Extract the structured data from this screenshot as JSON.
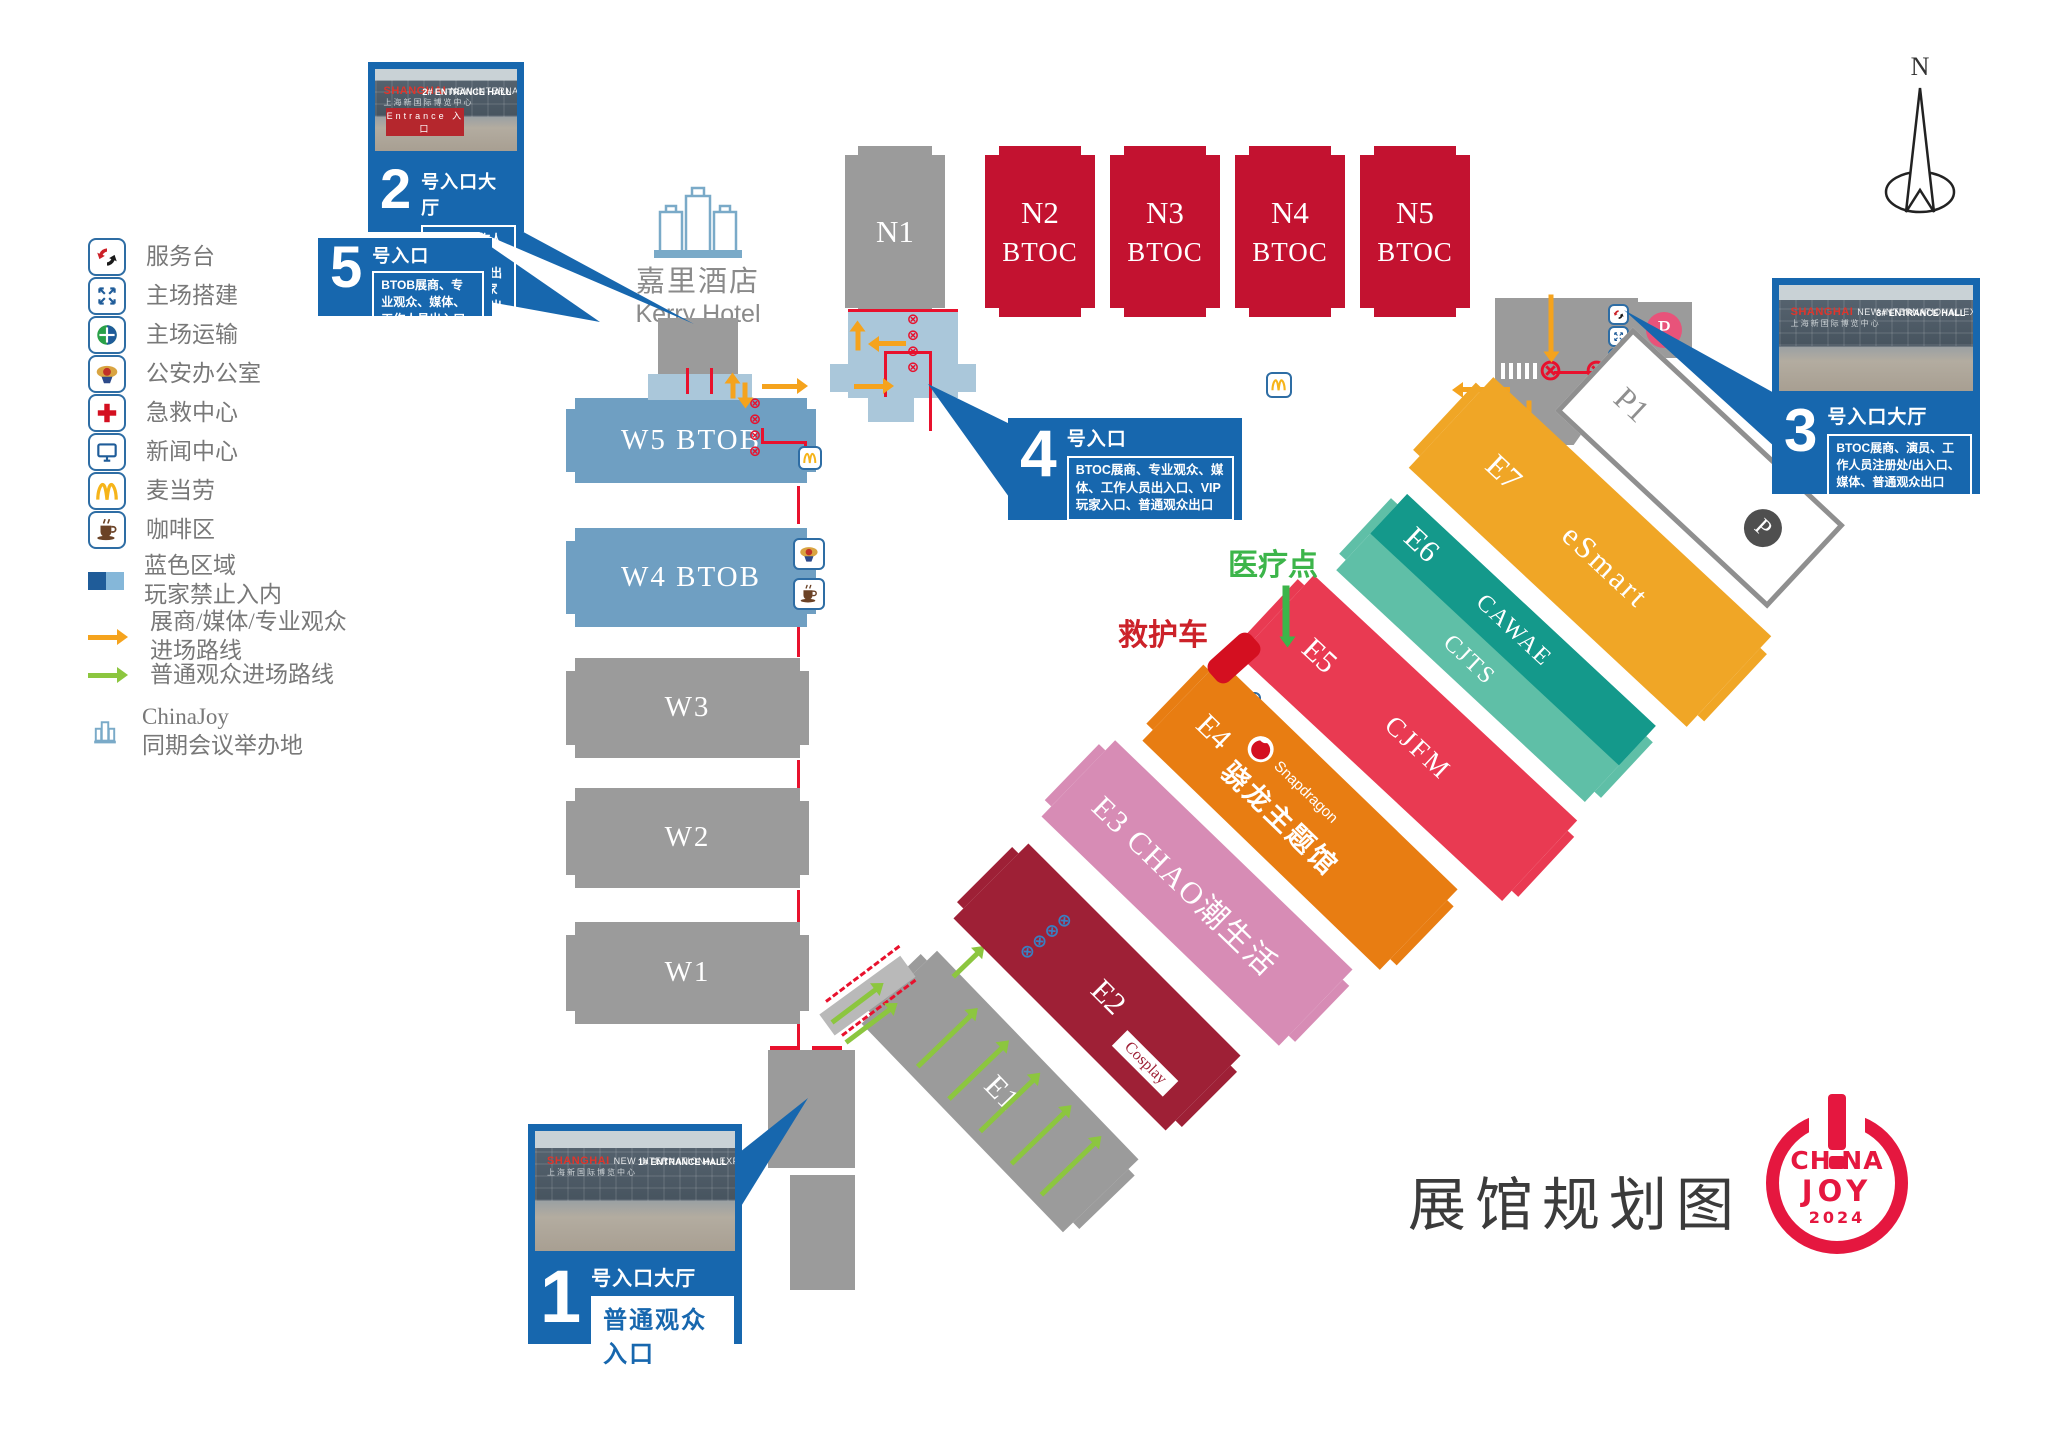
{
  "page": {
    "title": "展馆规划图"
  },
  "compass": {
    "label": "N"
  },
  "colors": {
    "callout_blue": "#1767ae",
    "hall_red": "#c31230",
    "hall_gray": "#9b9b9b",
    "hall_btob_blue": "#6f9fc2",
    "corridor_blue": "#aac7da",
    "route_orange": "#f5a31d",
    "route_green": "#8cc63f",
    "fence_red": "#e8112d",
    "logo_red": "#e5173f"
  },
  "legend": {
    "items": [
      {
        "icon": "service-desk-icon",
        "label": "服务台"
      },
      {
        "icon": "venue-setup-icon",
        "label": "主场搭建"
      },
      {
        "icon": "venue-transport-icon",
        "label": "主场运输"
      },
      {
        "icon": "police-office-icon",
        "label": "公安办公室"
      },
      {
        "icon": "first-aid-icon",
        "label": "急救中心"
      },
      {
        "icon": "news-center-icon",
        "label": "新闻中心"
      },
      {
        "icon": "mcdonalds-icon",
        "label": "麦当劳"
      },
      {
        "icon": "coffee-area-icon",
        "label": "咖啡区"
      },
      {
        "icon": "blue-area-swatch",
        "label1": "蓝色区域",
        "label2": "玩家禁止入内"
      },
      {
        "icon": "orange-route-arrow",
        "label1": "展商/媒体/专业观众",
        "label2": "进场路线"
      },
      {
        "icon": "green-route-arrow",
        "label": "普通观众进场路线"
      },
      {
        "icon": "conference-venue-icon",
        "label1": "ChinaJoy",
        "label2": "同期会议举办地"
      }
    ]
  },
  "kerry_hotel": {
    "cn": "嘉里酒店",
    "en": "Kerry Hotel"
  },
  "entrances": {
    "e1": {
      "num": "1",
      "title": "号入口大厅",
      "desc": "普通观众入口"
    },
    "e2": {
      "num": "2",
      "title": "号入口大厅",
      "desc": "展商、工作人员、专业观众、媒体进出口、VIP玩家入口、玩家出口"
    },
    "e3": {
      "num": "3",
      "title": "号入口大厅",
      "desc": "BTOC展商、演员、工作人员注册处/出入口、媒体、普通观众出口"
    },
    "e4": {
      "num": "4",
      "title": "号入口",
      "desc": "BTOC展商、专业观众、媒体、工作人员出入口、VIP玩家入口、普通观众出口"
    },
    "e5": {
      "num": "5",
      "title": "号入口",
      "desc": "BTOB展商、专业观众、媒体、工作人员出入口"
    }
  },
  "photo": {
    "sign_red": "SHANGHAI",
    "sign_white": "NEW INTERNATIONAL EXPO CENTRE",
    "sign_cn": "上海新国际博览中心",
    "hall2": "2# ENTRANCE HALL",
    "hall1": "1# ENTRANCE HALL",
    "hall3": "3# ENTRANCE HALL",
    "banner": "Entrance 入口"
  },
  "halls": {
    "north": [
      {
        "id": "N1",
        "sub": ""
      },
      {
        "id": "N2",
        "sub": "BTOC"
      },
      {
        "id": "N3",
        "sub": "BTOC"
      },
      {
        "id": "N4",
        "sub": "BTOC"
      },
      {
        "id": "N5",
        "sub": "BTOC"
      }
    ],
    "west": [
      {
        "label": "W5 BTOB"
      },
      {
        "label": "W4 BTOB"
      },
      {
        "label": "W3"
      },
      {
        "label": "W2"
      },
      {
        "label": "W1"
      }
    ],
    "east": [
      {
        "id": "E1",
        "name": ""
      },
      {
        "id": "E2",
        "name": "Cosplay"
      },
      {
        "id": "E3",
        "name": "CHAO潮生活"
      },
      {
        "id": "E4",
        "name": "骁龙主题馆",
        "brand": "Snapdragon"
      },
      {
        "id": "E5",
        "name": "CJFM"
      },
      {
        "id": "E6",
        "name": "CAWAE",
        "name2": "CJTS"
      },
      {
        "id": "E7",
        "name": "eSmart"
      }
    ]
  },
  "parking": {
    "p1": "P1",
    "p": "P"
  },
  "annotations": {
    "medical": "医疗点",
    "ambulance": "救护车"
  },
  "logo": {
    "l1a": "CH",
    "l1b": "NA",
    "l2": "JOY",
    "l3": "2024"
  }
}
